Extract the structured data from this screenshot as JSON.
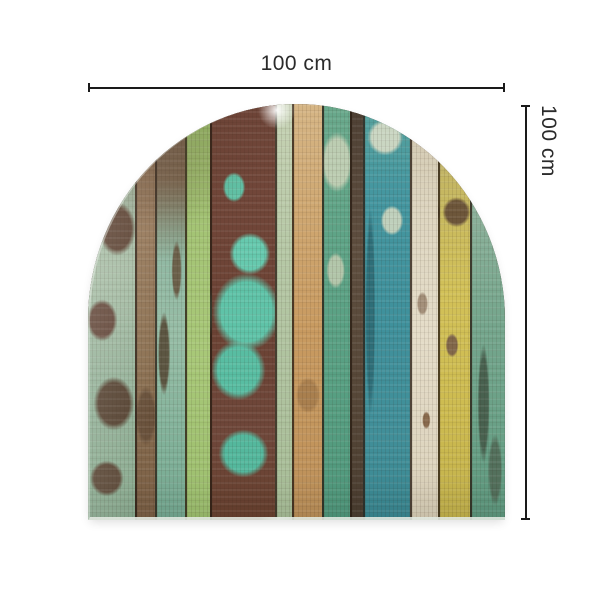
{
  "dimensions": {
    "width_label": "100 cm",
    "height_label": "100 cm",
    "line_color": "#1a1a1a",
    "text_color": "#2b2b2b"
  },
  "panel": {
    "description": "arched panel of distressed multicolor painted wood planks",
    "shape": "arch",
    "seam_color": "rgba(43,30,20,0.8)",
    "planks": [
      {
        "w": 47,
        "stops": [
          "#8a7256 0%",
          "#9db49c 18%",
          "#a7bda5 40%",
          "#93b198 70%",
          "#8aab90 100%"
        ],
        "patches": [
          {
            "c": "#5e4434",
            "x": "62%",
            "y": "30%",
            "w": "55%",
            "h": "9%"
          },
          {
            "c": "#64483a",
            "x": "30%",
            "y": "52%",
            "w": "45%",
            "h": "7%"
          },
          {
            "c": "#584534",
            "x": "55%",
            "y": "72%",
            "w": "60%",
            "h": "9%"
          },
          {
            "c": "#5e4b3a",
            "x": "40%",
            "y": "90%",
            "w": "50%",
            "h": "6%"
          }
        ]
      },
      {
        "w": 20,
        "stops": [
          "#7c6148 0%",
          "#97795a 30%",
          "#8d7253 60%",
          "#7a5f45 100%"
        ],
        "patches": [
          {
            "c": "#6a523c",
            "x": "50%",
            "y": "75%",
            "w": "80%",
            "h": "10%"
          }
        ]
      },
      {
        "w": 30,
        "stops": [
          "#6d5743 0%",
          "#7a654e 18%",
          "#8fb8a2 38%",
          "#97bda6 55%",
          "#82b29a 80%",
          "#74a891 100%"
        ],
        "patches": [
          {
            "c": "#5c5642",
            "x": "25%",
            "y": "60%",
            "w": "30%",
            "h": "14%"
          },
          {
            "c": "#6b604a",
            "x": "70%",
            "y": "40%",
            "w": "25%",
            "h": "10%"
          }
        ]
      },
      {
        "w": 25,
        "stops": [
          "#90ae62 0%",
          "#a4c475 30%",
          "#a8c878 60%",
          "#9cbe6e 100%"
        ],
        "patches": []
      },
      {
        "w": 65,
        "stops": [
          "#6d4437 0%",
          "#714639 22%",
          "#6b4234 55%",
          "#6f473a 80%",
          "#68412f 100%"
        ],
        "patches": [
          {
            "c": "#61c2a6",
            "x": "35%",
            "y": "20%",
            "w": "25%",
            "h": "5%"
          },
          {
            "c": "#66c9ae",
            "x": "60%",
            "y": "36%",
            "w": "45%",
            "h": "7%"
          },
          {
            "c": "#5fc3a8",
            "x": "55%",
            "y": "50%",
            "w": "75%",
            "h": "13%"
          },
          {
            "c": "#58bda2",
            "x": "42%",
            "y": "64%",
            "w": "60%",
            "h": "10%"
          },
          {
            "c": "#54b89d",
            "x": "50%",
            "y": "84%",
            "w": "55%",
            "h": "8%"
          }
        ]
      },
      {
        "w": 17,
        "stops": [
          "#c6d2b4 0%",
          "#b6c8a6 35%",
          "#aec29e 70%",
          "#a6bc96 100%"
        ],
        "patches": []
      },
      {
        "w": 30,
        "stops": [
          "#d6b686 0%",
          "#cfa872 25%",
          "#c89a60 55%",
          "#c1945c 85%",
          "#b98e58 100%"
        ],
        "patches": [
          {
            "c": "#a97f4e",
            "x": "50%",
            "y": "70%",
            "w": "60%",
            "h": "6%"
          }
        ]
      },
      {
        "w": 28,
        "stops": [
          "#6aa98c 0%",
          "#5fa487 30%",
          "#58a083 65%",
          "#4f977b 100%"
        ],
        "patches": [
          {
            "c": "#bccdb2",
            "x": "50%",
            "y": "14%",
            "w": "85%",
            "h": "10%"
          },
          {
            "c": "#b2c6aa",
            "x": "45%",
            "y": "40%",
            "w": "50%",
            "h": "6%"
          }
        ]
      },
      {
        "w": 13,
        "stops": [
          "#4e4034 0%",
          "#5e4e3f 35%",
          "#564738 70%",
          "#4a3d30 100%"
        ],
        "patches": []
      },
      {
        "w": 47,
        "stops": [
          "#58a39d 0%",
          "#4597a0 20%",
          "#3f919c 50%",
          "#418f99 80%",
          "#3a8791 100%"
        ],
        "patches": [
          {
            "c": "#cad6c2",
            "x": "45%",
            "y": "8%",
            "w": "55%",
            "h": "6%"
          },
          {
            "c": "#bfd0bc",
            "x": "60%",
            "y": "28%",
            "w": "35%",
            "h": "5%"
          },
          {
            "c": "#2e6e78",
            "x": "12%",
            "y": "50%",
            "w": "15%",
            "h": "35%"
          }
        ]
      },
      {
        "w": 28,
        "stops": [
          "#cec4ac 0%",
          "#ddd5bf 25%",
          "#e4dcc8 55%",
          "#ded5bf 85%",
          "#d6ccb4 100%"
        ],
        "patches": [
          {
            "c": "#a4907a",
            "x": "40%",
            "y": "48%",
            "w": "30%",
            "h": "4%"
          },
          {
            "c": "#8a6b4e",
            "x": "55%",
            "y": "76%",
            "w": "22%",
            "h": "3%"
          }
        ]
      },
      {
        "w": 32,
        "stops": [
          "#b3ab92 0%",
          "#c4b662 18%",
          "#d2c158 45%",
          "#cdbb50 75%",
          "#c2b14c 100%"
        ],
        "patches": [
          {
            "c": "#6d563a",
            "x": "55%",
            "y": "26%",
            "w": "65%",
            "h": "5%"
          },
          {
            "c": "#82684a",
            "x": "40%",
            "y": "58%",
            "w": "30%",
            "h": "4%"
          }
        ]
      },
      {
        "w": 35,
        "stops": [
          "#b2b6a4 0%",
          "#8fb29c 22%",
          "#77a78e 50%",
          "#68a086 80%",
          "#5d977d 100%"
        ],
        "patches": [
          {
            "c": "#48614f",
            "x": "35%",
            "y": "72%",
            "w": "25%",
            "h": "20%"
          },
          {
            "c": "#53705c",
            "x": "70%",
            "y": "88%",
            "w": "30%",
            "h": "12%"
          }
        ]
      }
    ]
  }
}
